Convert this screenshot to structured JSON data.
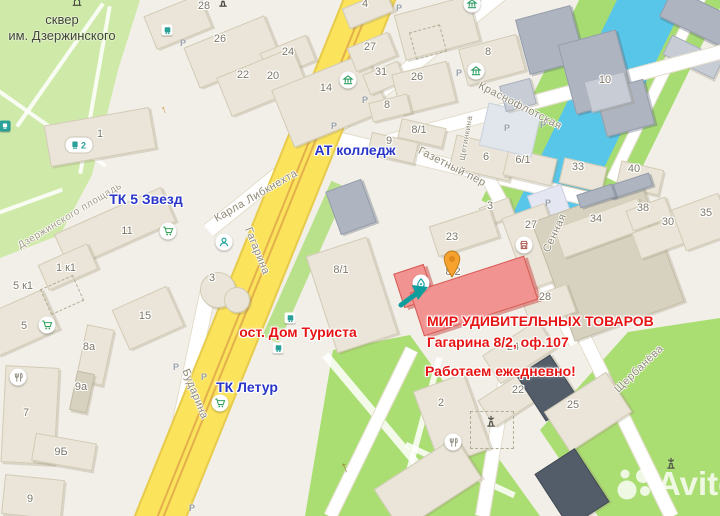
{
  "map": {
    "watermark": "Avito",
    "park": {
      "line1": "сквер",
      "line2": "им. Дзержинского"
    },
    "annotations": {
      "tk5zvezd": "ТК 5 Звезд",
      "at_college": "АТ колледж",
      "tk_letur": "ТК Летур",
      "bus_stop": "ост. Дом Туриста",
      "shop_title": "МИР УДИВИТЕЛЬНЫХ ТОВАРОВ",
      "shop_address": "Гагарина 8/2, оф.107",
      "shop_hours": "Работаем ежедневно!"
    },
    "streets": {
      "dzerzhinskogo": "Дзержинского площадь",
      "karla_libknehta": "Карла Либкнехта",
      "gagarina": "Гагарина",
      "krasnoflotskaya": "Краснофлотская",
      "gazetny": "Газетный пер",
      "shchetinkina": "Щетинкина",
      "sennaya": "Сенная",
      "shcherbaneva": "Щербанёва",
      "budarina": "Бударина"
    },
    "buildings": [
      "28",
      "26",
      "24",
      "22",
      "20",
      "14",
      "27",
      "31",
      "26",
      "8",
      "8/1",
      "9",
      "4",
      "8",
      "10",
      "6",
      "6/1",
      "33",
      "40",
      "1",
      "11",
      "1 к1",
      "5 к1",
      "5",
      "15",
      "3",
      "7",
      "8а",
      "9а",
      "9Б",
      "9",
      "3",
      "27",
      "34",
      "38",
      "30",
      "35",
      "28",
      "23",
      "8/2",
      "8/1",
      "24",
      "22",
      "25",
      "2"
    ],
    "parking_label": "P",
    "tram_route": "2",
    "colors": {
      "annotation_red": "#e61414",
      "annotation_blue": "#2835c8",
      "road_yellow": "#fbe35c",
      "water_blue": "#58c6e9",
      "park_green": "#cfeaa8",
      "lawn_green": "#abde72",
      "highlight_building": "#f19390",
      "pin_orange": "#f7a12e",
      "arrow_teal": "#0f9d9d"
    }
  }
}
